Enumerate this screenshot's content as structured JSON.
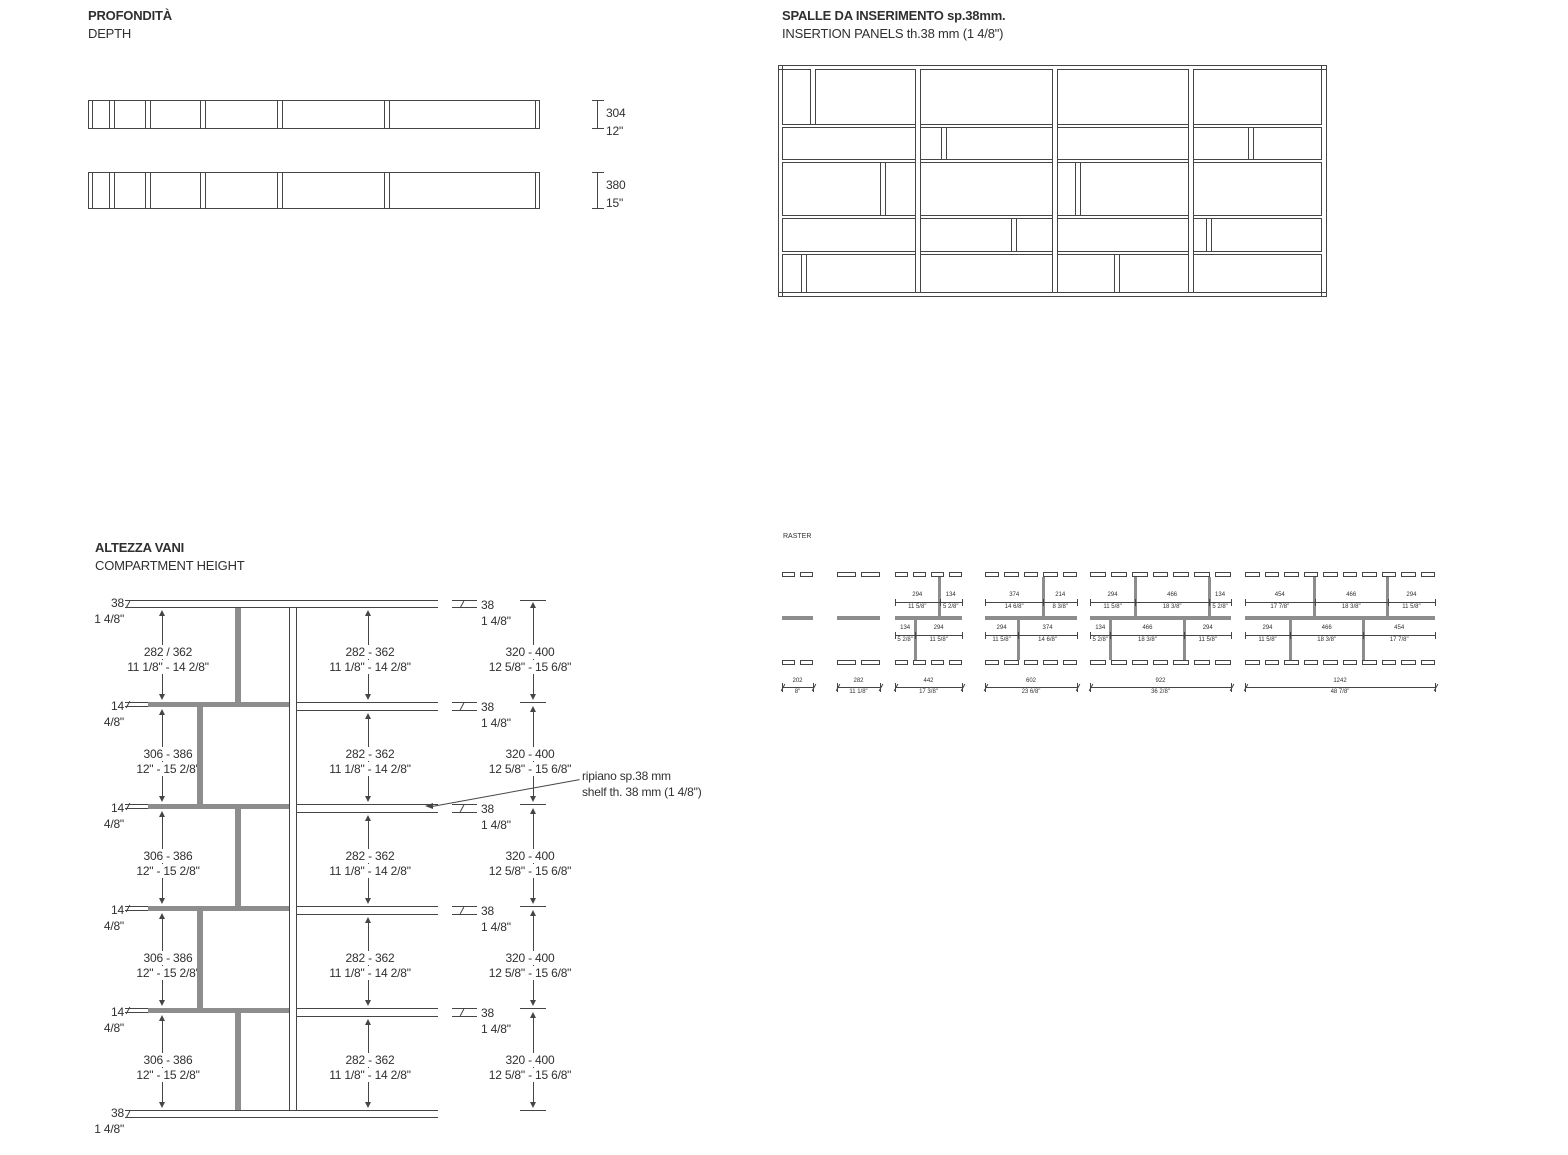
{
  "page": {
    "background": "#ffffff",
    "line_color": "#454545",
    "gray_fill": "#8d8d8d",
    "text_color": "#303030"
  },
  "sections": {
    "depth": {
      "title_it": "PROFONDITÀ",
      "title_en": "DEPTH",
      "bars": [
        {
          "dim_mm": "304",
          "dim_in": "12\""
        },
        {
          "dim_mm": "380",
          "dim_in": "15\""
        }
      ]
    },
    "insertion_panels": {
      "title_it": "SPALLE DA INSERIMENTO sp.38mm.",
      "title_en": "INSERTION PANELS th.38 mm (1 4/8\")"
    },
    "compartment_height": {
      "title_it": "ALTEZZA VANI",
      "title_en": "COMPARTMENT HEIGHT",
      "left_top_thickness": {
        "mm": "38",
        "in": "1 4/8\""
      },
      "left_bottom_thickness": {
        "mm": "38",
        "in": "1 4/8\""
      },
      "left_shelf_thickness": {
        "mm": "14",
        "in": "4/8\""
      },
      "right_shelf_thickness": {
        "mm": "38",
        "in": "1 4/8\""
      },
      "left_compartments": [
        {
          "mm": "282 / 362",
          "in": "11 1/8\" - 14 2/8\""
        },
        {
          "mm": "306 - 386",
          "in": "12\" - 15 2/8\""
        },
        {
          "mm": "306 - 386",
          "in": "12\" - 15 2/8\""
        },
        {
          "mm": "306 - 386",
          "in": "12\" - 15 2/8\""
        },
        {
          "mm": "306 - 386",
          "in": "12\" - 15 2/8\""
        }
      ],
      "middle_compartments": [
        {
          "mm": "282 - 362",
          "in": "11 1/8\" - 14 2/8\""
        },
        {
          "mm": "282 - 362",
          "in": "11 1/8\" - 14 2/8\""
        },
        {
          "mm": "282 - 362",
          "in": "11 1/8\" - 14 2/8\""
        },
        {
          "mm": "282 - 362",
          "in": "11 1/8\" - 14 2/8\""
        },
        {
          "mm": "282 - 362",
          "in": "11 1/8\" - 14 2/8\""
        }
      ],
      "right_compartments": [
        {
          "mm": "320 - 400",
          "in": "12 5/8\" - 15 6/8\""
        },
        {
          "mm": "320 - 400",
          "in": "12 5/8\" - 15 6/8\""
        },
        {
          "mm": "320 - 400",
          "in": "12 5/8\" - 15 6/8\""
        },
        {
          "mm": "320 - 400",
          "in": "12 5/8\" - 15 6/8\""
        },
        {
          "mm": "320 - 400",
          "in": "12 5/8\" - 15 6/8\""
        }
      ],
      "annotation": {
        "line1": "ripiano sp.38 mm",
        "line2": "shelf th. 38 mm (1 4/8\")"
      }
    },
    "raster": {
      "title": "RASTER",
      "modules": [
        {
          "width_mm": "202",
          "width_in": "8\"",
          "top_segments": [],
          "bottom_segments": []
        },
        {
          "width_mm": "282",
          "width_in": "11 1/8\"",
          "top_segments": [],
          "bottom_segments": []
        },
        {
          "width_mm": "442",
          "width_in": "17 3/8\"",
          "top_segments": [
            {
              "mm": "294",
              "in": "11 5/8\""
            },
            {
              "mm": "134",
              "in": "5 2/8\""
            }
          ],
          "bottom_segments": [
            {
              "mm": "134",
              "in": "5 2/8\""
            },
            {
              "mm": "294",
              "in": "11 5/8\""
            }
          ]
        },
        {
          "width_mm": "602",
          "width_in": "23 6/8\"",
          "top_segments": [
            {
              "mm": "374",
              "in": "14 6/8\""
            },
            {
              "mm": "214",
              "in": "8 3/8\""
            }
          ],
          "bottom_segments": [
            {
              "mm": "294",
              "in": "11 5/8\""
            },
            {
              "mm": "374",
              "in": "14 6/8\""
            }
          ]
        },
        {
          "width_mm": "922",
          "width_in": "36 2/8\"",
          "top_segments": [
            {
              "mm": "294",
              "in": "11 5/8\""
            },
            {
              "mm": "466",
              "in": "18 3/8\""
            },
            {
              "mm": "134",
              "in": "5 2/8\""
            }
          ],
          "bottom_segments": [
            {
              "mm": "134",
              "in": "5 2/8\""
            },
            {
              "mm": "466",
              "in": "18 3/8\""
            },
            {
              "mm": "294",
              "in": "11 5/8\""
            }
          ]
        },
        {
          "width_mm": "1242",
          "width_in": "48 7/8\"",
          "top_segments": [
            {
              "mm": "454",
              "in": "17 7/8\""
            },
            {
              "mm": "466",
              "in": "18 3/8\""
            },
            {
              "mm": "294",
              "in": "11 5/8\""
            }
          ],
          "bottom_segments": [
            {
              "mm": "294",
              "in": "11 5/8\""
            },
            {
              "mm": "466",
              "in": "18 3/8\""
            },
            {
              "mm": "454",
              "in": "17 7/8\""
            }
          ]
        }
      ]
    }
  }
}
